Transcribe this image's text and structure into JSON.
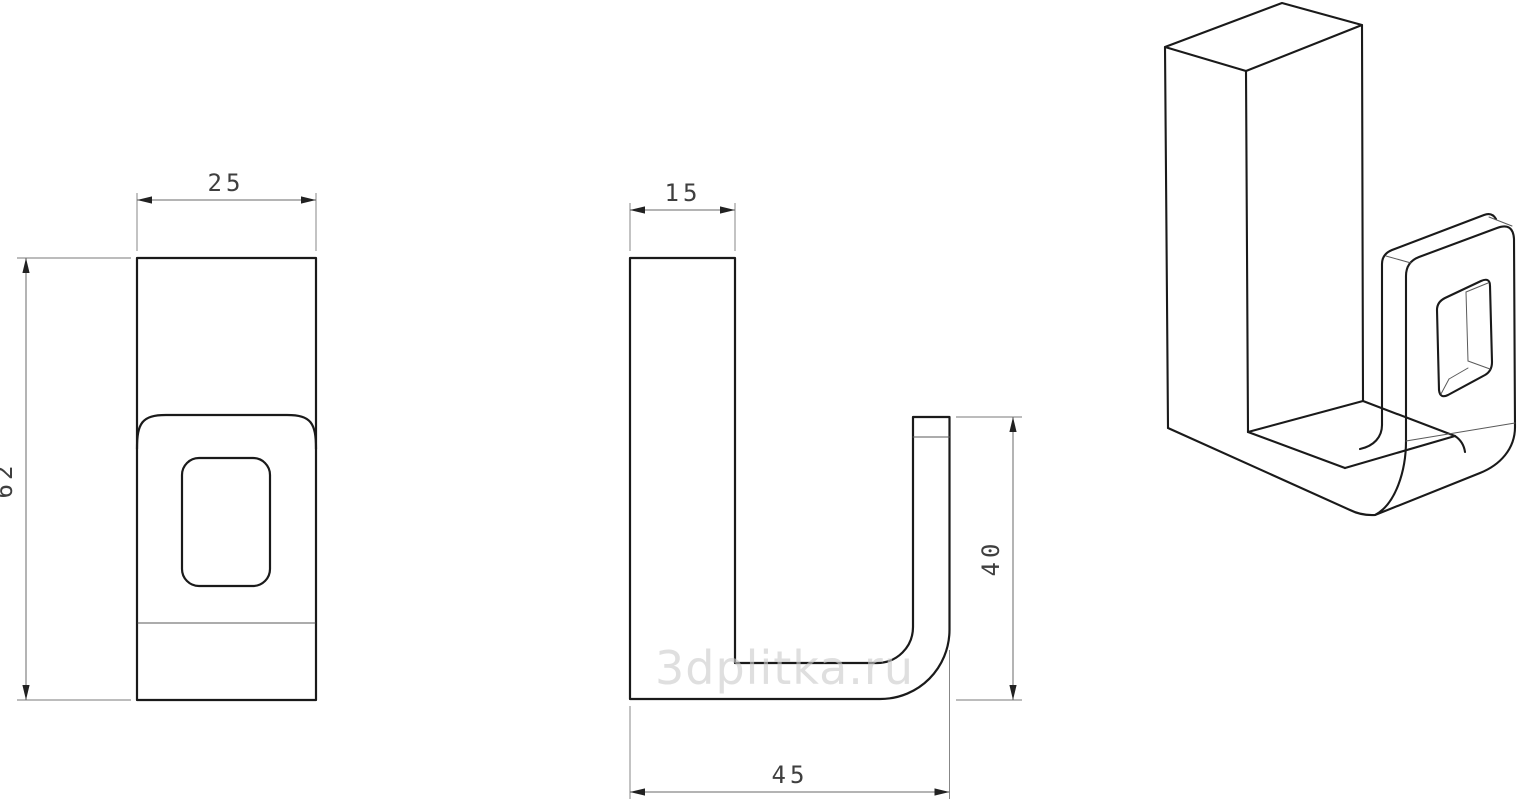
{
  "drawing": {
    "type": "technical-drawing",
    "subject": "wall hook bracket, three views (front, side, isometric)",
    "watermark": "3dplitka.ru",
    "dimensions": {
      "front_width": "25",
      "front_height": "62",
      "side_thickness": "15",
      "side_hook_height": "40",
      "side_depth": "45"
    },
    "units_note": "",
    "colors": {
      "outline": "#1a1a1a",
      "dimension_line": "#6a6a6a",
      "dimension_text": "#3f3f3f",
      "watermark": "#cccccc",
      "background": "#ffffff"
    }
  }
}
